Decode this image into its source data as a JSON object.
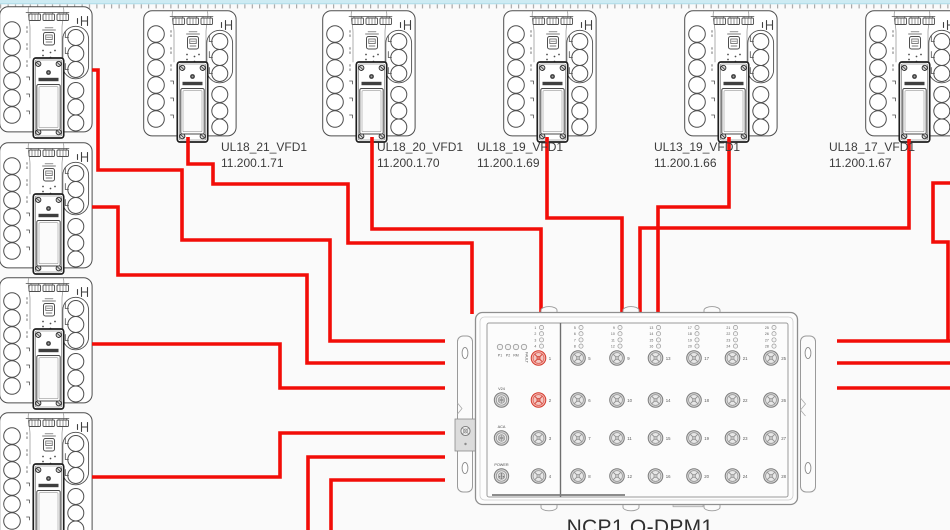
{
  "colors": {
    "wire": "#f20d08",
    "ruler_band": "#cdebf3",
    "ruler_edge": "#aedbe7",
    "tick": "#8d8d8d",
    "port_highlight": "#d2392c"
  },
  "devices": {
    "top_row": [
      {
        "label": "UL18_21_VFD1",
        "ip": "11.200.1.71",
        "x": 143,
        "y": 10,
        "label_x": 221,
        "label_y": 140
      },
      {
        "label": "UL18_20_VFD1",
        "ip": "11.200.1.70",
        "x": 322,
        "y": 10,
        "label_x": 377,
        "label_y": 140
      },
      {
        "label": "UL18_19_VFD1",
        "ip": "11.200.1.69",
        "x": 503,
        "y": 10,
        "label_x": 477,
        "label_y": 140
      },
      {
        "label": "UL13_19_VFD1",
        "ip": "11.200.1.66",
        "x": 684,
        "y": 10,
        "label_x": 654,
        "label_y": 140
      },
      {
        "label": "UL18_17_VFD1",
        "ip": "11.200.1.67",
        "x": 865,
        "y": 10,
        "label_x": 829,
        "label_y": 140
      }
    ],
    "left_column": [
      {
        "x": -1,
        "y": 6
      },
      {
        "x": -1,
        "y": 142
      },
      {
        "x": -1,
        "y": 277
      },
      {
        "x": -1,
        "y": 412
      }
    ]
  },
  "wires": [
    {
      "points": [
        [
          92,
          70
        ],
        [
          98,
          70
        ],
        [
          98,
          170
        ],
        [
          182,
          170
        ],
        [
          182,
          240
        ],
        [
          330,
          240
        ],
        [
          330,
          341
        ],
        [
          445,
          341
        ]
      ]
    },
    {
      "points": [
        [
          92,
          207
        ],
        [
          118,
          207
        ],
        [
          118,
          275
        ],
        [
          307,
          275
        ],
        [
          307,
          363
        ],
        [
          445,
          363
        ]
      ]
    },
    {
      "points": [
        [
          92,
          344
        ],
        [
          280,
          344
        ],
        [
          280,
          388
        ],
        [
          445,
          388
        ]
      ]
    },
    {
      "points": [
        [
          92,
          477
        ],
        [
          280,
          477
        ],
        [
          280,
          433
        ],
        [
          445,
          433
        ]
      ]
    },
    {
      "points": [
        [
          445,
          457
        ],
        [
          308,
          457
        ],
        [
          308,
          532
        ]
      ]
    },
    {
      "points": [
        [
          445,
          480
        ],
        [
          331,
          480
        ],
        [
          331,
          532
        ]
      ]
    },
    {
      "points": [
        [
          188,
          137
        ],
        [
          188,
          164
        ],
        [
          213,
          164
        ],
        [
          213,
          184
        ],
        [
          348,
          184
        ],
        [
          348,
          243
        ],
        [
          472,
          243
        ],
        [
          472,
          314
        ]
      ]
    },
    {
      "points": [
        [
          372,
          137
        ],
        [
          372,
          229
        ],
        [
          541,
          229
        ],
        [
          541,
          314
        ]
      ]
    },
    {
      "points": [
        [
          547,
          137
        ],
        [
          547,
          218
        ],
        [
          622,
          218
        ],
        [
          622,
          314
        ]
      ]
    },
    {
      "points": [
        [
          729,
          137
        ],
        [
          729,
          207
        ],
        [
          658,
          207
        ],
        [
          658,
          314
        ]
      ]
    },
    {
      "points": [
        [
          909,
          139
        ],
        [
          909,
          228
        ],
        [
          640,
          228
        ],
        [
          640,
          314
        ]
      ]
    },
    {
      "points": [
        [
          950,
          183
        ],
        [
          933,
          183
        ],
        [
          933,
          242
        ],
        [
          948,
          242
        ],
        [
          948,
          341
        ]
      ]
    },
    {
      "points": [
        [
          837,
          341
        ],
        [
          950,
          341
        ]
      ]
    },
    {
      "points": [
        [
          837,
          363
        ],
        [
          950,
          363
        ]
      ]
    },
    {
      "points": [
        [
          837,
          388
        ],
        [
          950,
          388
        ]
      ]
    }
  ],
  "dbx": {
    "name": "NCP1 Q-DPM1",
    "status_leds": [
      "P1",
      "P2",
      "RM",
      "FAULT"
    ],
    "aux_ports": [
      "V24",
      "ACA",
      "POWER"
    ],
    "highlighted_ports": [
      1,
      2
    ],
    "port_groups": [
      [
        1,
        2,
        3,
        4
      ],
      [
        5,
        6,
        7,
        8
      ],
      [
        9,
        10,
        11,
        12
      ],
      [
        13,
        14,
        15,
        16
      ],
      [
        17,
        18,
        19,
        20
      ],
      [
        21,
        22,
        23,
        24
      ],
      [
        25,
        26,
        27,
        28
      ]
    ]
  }
}
